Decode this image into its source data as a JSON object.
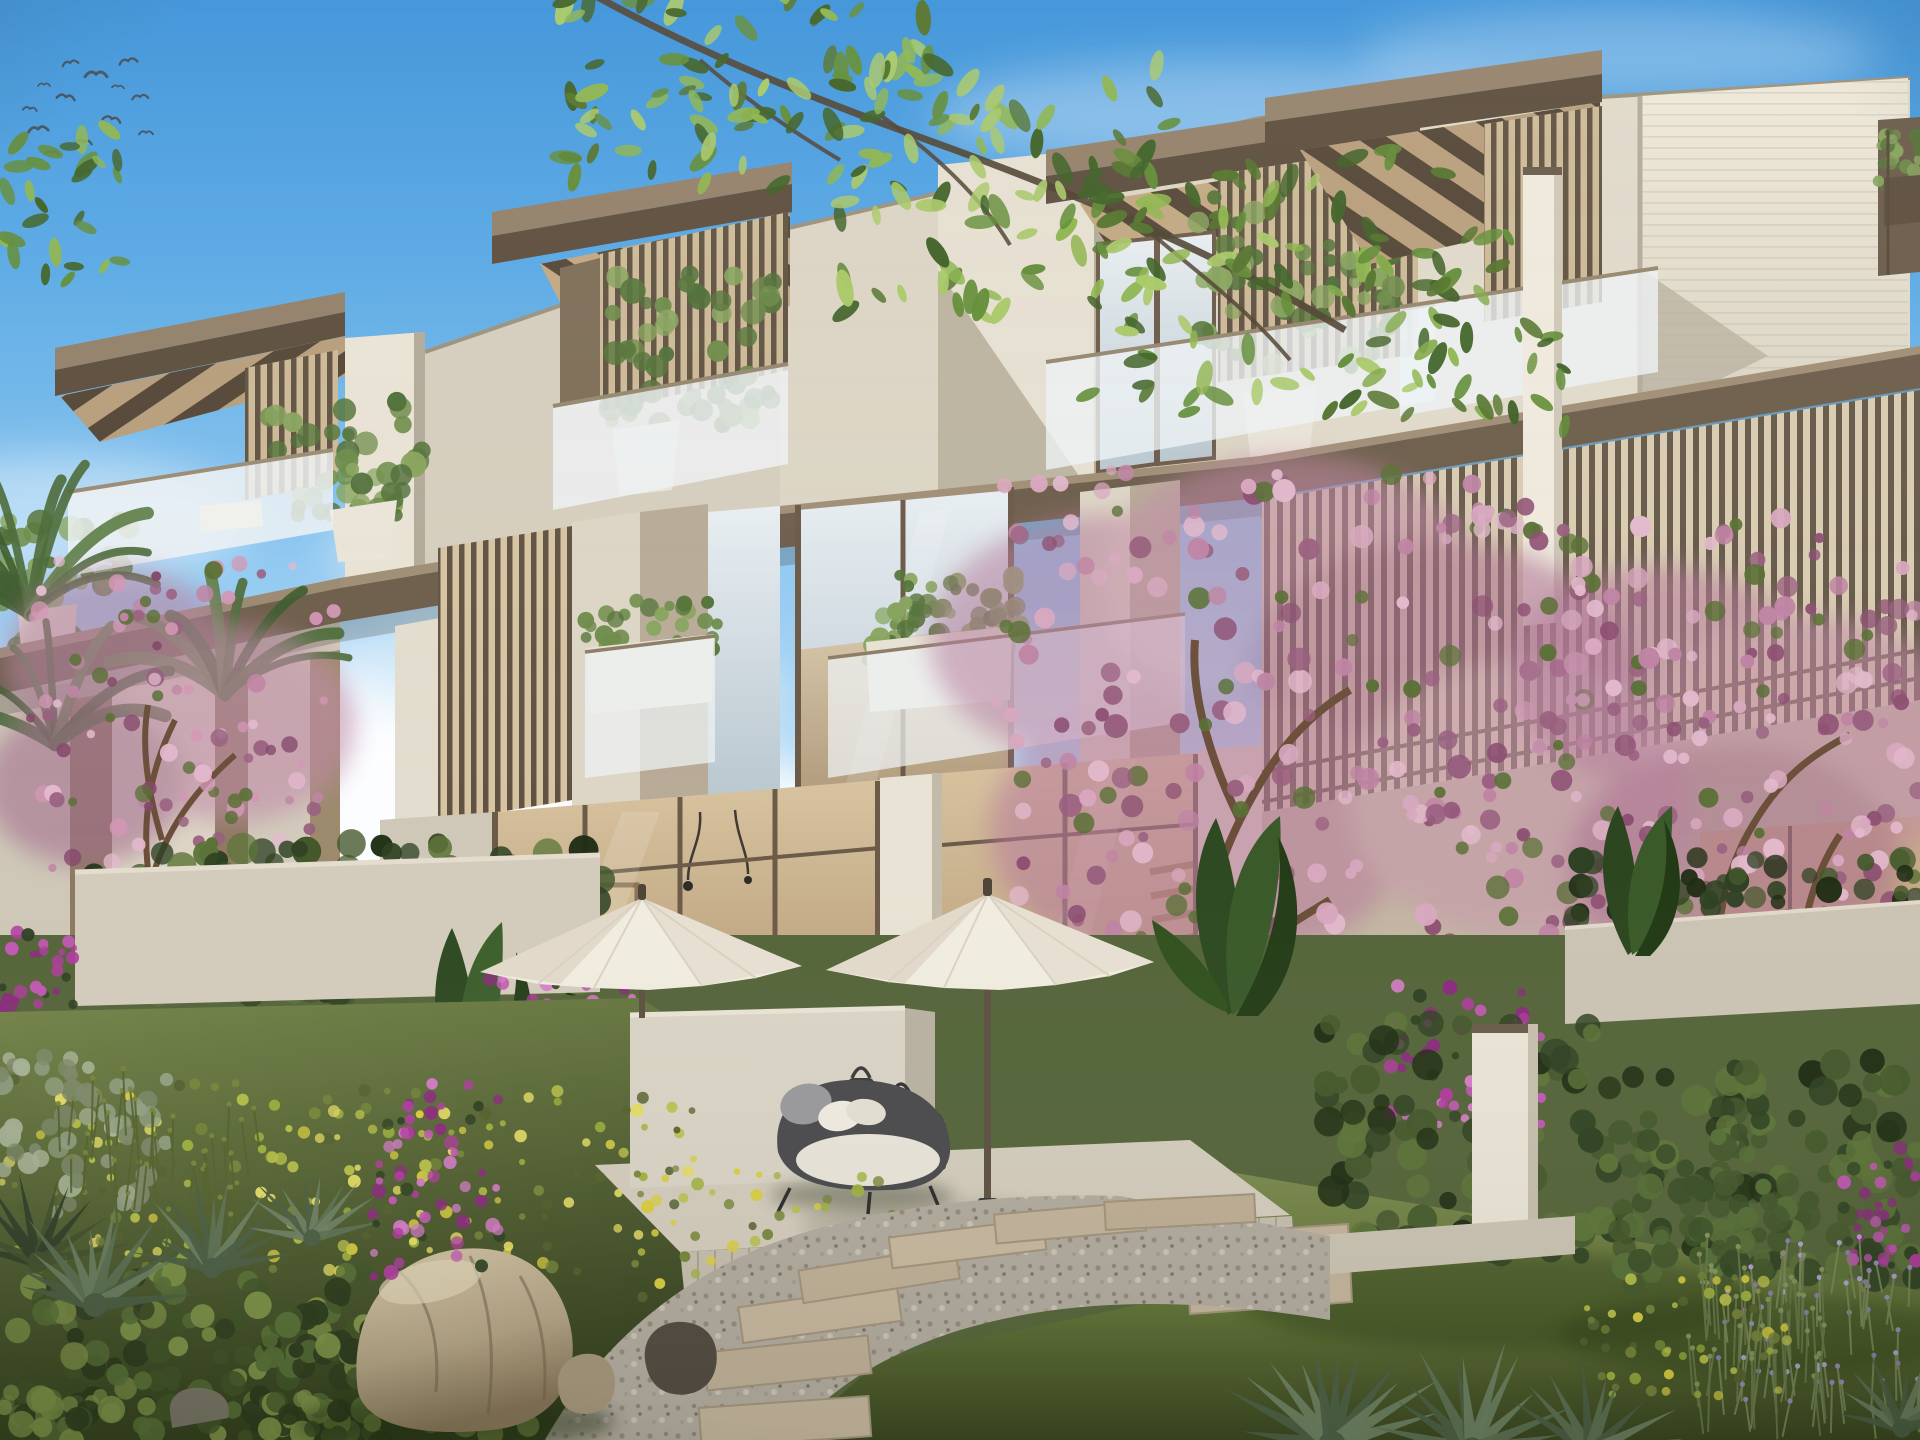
{
  "meta": {
    "content_type": "architectural-rendering",
    "subject": "modern three-storey townhouse terrace with landscaped garden, patio and flowering trees",
    "time_of_day": "day",
    "no_visible_text": true
  },
  "palette": {
    "sky_top": "#3e96dd",
    "sky_high": "#5fb0e9",
    "sky_mid": "#8fc9f1",
    "sky_low": "#c7e4f8",
    "cloud_white": "#f8fbfd",
    "bird": "#3f444b",
    "branch_wood": "#4f4232",
    "leaf_bright": "#8db54e",
    "leaf_mid": "#618c36",
    "leaf_dark": "#3e6126",
    "facade_light": "#e9e3d5",
    "facade_mid": "#d5cebe",
    "facade_shadow": "#b9b1a0",
    "soffit_warm": "#c2a883",
    "wood_fascia": "#5d4e3e",
    "wood_slab": "#93816a",
    "slat_dark": "#574a3b",
    "slat_backing": "#d2c0a0",
    "frame_bronze": "#6c5b49",
    "glass_sky": "#dfe9ee",
    "glass_warm": "#c9ae88",
    "balustrade_frost": "#eef2f5",
    "rail_bronze": "#8d7d67",
    "interior_wall": "#d9c4a2",
    "sofa_white": "#e9e3d7",
    "cushion_blue": "#67809a",
    "stair_wood": "#a5885f",
    "planter_white": "#eae5d8",
    "olive_green": "#6d8c4a",
    "blossom_light": "#e2b9cc",
    "blossom_mid": "#c084a4",
    "blossom_dark": "#99607f",
    "trunk_brown": "#6b4f3a",
    "palm_green": "#4c6b3a",
    "hedge_dark": "#2f4223",
    "hedge_mid": "#44582c",
    "hedge_light": "#5d7539",
    "flower_magenta": "#b13c9f",
    "flower_yellow": "#d9ce41",
    "drift_green": "#9fb33e",
    "agave_green": "#5d7254",
    "agave_light": "#8fa383",
    "silver_shrub": "#93a084",
    "lawn_light": "#7d8d4f",
    "lawn_mid": "#5e7036",
    "lawn_dark": "#3a4722",
    "gravel": "#b2ab9f",
    "path_stone": "#c3b49c",
    "kerb_stone": "#cbc4b4",
    "boulder_light": "#cdbd9f",
    "boulder_dark": "#8a7a5e",
    "rock_dark": "#4a443a",
    "deck_tile": "#d2cbbc",
    "privacy_wall": "#dad4c6",
    "furniture_shell": "#4a4a4d",
    "cushion_white": "#eae6da",
    "lantern_dark": "#3b3b3d",
    "umbrella_light": "#f1ece0",
    "umbrella_shade": "#d5cbb8",
    "umbrella_pole": "#5d5144",
    "lavender": "#9b8fc0"
  },
  "scene": {
    "sky": {
      "elements": [
        "gradient-sky",
        "cumulus-cloud-bank-left",
        "high-wisps",
        "flock-of-birds"
      ]
    },
    "building": {
      "storeys": 3,
      "units_visible": 4,
      "features": [
        "slatted-timber-canopies",
        "vertical-bronze-louvre-screens",
        "frosted-glass-balustrades",
        "travertine-piers",
        "floor-to-ceiling-glazing",
        "olive-trees-in-white-pots",
        "sunlit-blank-wall-with-diagonal-shadow"
      ]
    },
    "garden": {
      "features": [
        "pink-flowering-trees",
        "palm-fronds",
        "clipped-hedges",
        "purple-flower-beds",
        "yellow-green-drift",
        "agave-rosettes",
        "banana-plants",
        "boulder",
        "gravel-path-with-stepping-stones",
        "lawn",
        "lavender-bed"
      ]
    },
    "patio": {
      "items": [
        "privacy-wall",
        "daybed-with-white-cushion",
        "three-lanterns",
        "white-parasol-left",
        "white-parasol-right",
        "partial-parasol-far-right",
        "tiled-deck"
      ]
    }
  },
  "birds": [
    [
      38,
      128,
      10,
      -6
    ],
    [
      66,
      96,
      9,
      8
    ],
    [
      96,
      73,
      11,
      0
    ],
    [
      128,
      60,
      9,
      -10
    ],
    [
      84,
      141,
      8,
      5
    ],
    [
      52,
      152,
      7,
      0
    ],
    [
      112,
      118,
      9,
      12
    ],
    [
      140,
      96,
      8,
      -5
    ],
    [
      30,
      108,
      7,
      6
    ],
    [
      146,
      132,
      7,
      0
    ],
    [
      70,
      62,
      8,
      -12
    ],
    [
      118,
      86,
      6,
      4
    ],
    [
      44,
      84,
      6,
      0
    ]
  ],
  "scatters": [
    {
      "id": "leaves-1",
      "type": "leaves",
      "bounds": [
        540,
        -10,
        390,
        200
      ],
      "n": 75,
      "rmin": 9,
      "rmax": 19,
      "colors": [
        "#8db54e",
        "#618c36",
        "#3e6126",
        "#a8c868",
        "#54732e"
      ],
      "seed": 11
    },
    {
      "id": "leaves-2",
      "type": "leaves",
      "bounds": [
        830,
        60,
        340,
        265
      ],
      "n": 80,
      "rmin": 9,
      "rmax": 19,
      "colors": [
        "#8db54e",
        "#618c36",
        "#3e6126",
        "#a8c868",
        "#54732e"
      ],
      "seed": 12
    },
    {
      "id": "leaves-3",
      "type": "leaves",
      "bounds": [
        1085,
        150,
        370,
        270
      ],
      "n": 72,
      "rmin": 9,
      "rmax": 18,
      "colors": [
        "#8db54e",
        "#618c36",
        "#3e6126",
        "#a8c868",
        "#54732e"
      ],
      "seed": 13
    },
    {
      "id": "leaves-4",
      "type": "leaves",
      "bounds": [
        1330,
        235,
        235,
        195
      ],
      "n": 42,
      "rmin": 8,
      "rmax": 16,
      "colors": [
        "#7fa947",
        "#618c36",
        "#3e6126",
        "#54732e"
      ],
      "seed": 14
    },
    {
      "id": "leaves-corner",
      "type": "leaves",
      "bounds": [
        0,
        128,
        125,
        155
      ],
      "n": 28,
      "rmin": 8,
      "rmax": 15,
      "colors": [
        "#8db54e",
        "#618c36",
        "#3e6126"
      ],
      "seed": 15
    },
    {
      "id": "blossom-a",
      "type": "circles",
      "bounds": [
        15,
        555,
        330,
        315
      ],
      "n": 95,
      "rmin": 4,
      "rmax": 9.5,
      "colors": [
        "#e2b9cc",
        "#c084a4",
        "#99607f",
        "#d397b4",
        "#85486a"
      ],
      "green": "#5a7036",
      "seed": 21
    },
    {
      "id": "blossom-b",
      "type": "circles",
      "bounds": [
        995,
        468,
        590,
        545
      ],
      "n": 235,
      "rmin": 5,
      "rmax": 12,
      "colors": [
        "#e2b9cc",
        "#c084a4",
        "#99607f",
        "#d8a8bf",
        "#8d4f72"
      ],
      "green": "#5a7036",
      "seed": 22
    },
    {
      "id": "blossom-c",
      "type": "circles",
      "bounds": [
        1545,
        515,
        375,
        450
      ],
      "n": 165,
      "rmin": 5,
      "rmax": 11,
      "colors": [
        "#e2b9cc",
        "#c084a4",
        "#99607f",
        "#d8a8bf",
        "#8d4f72"
      ],
      "green": "#5a7036",
      "seed": 23
    },
    {
      "id": "purple-1",
      "type": "circles",
      "bounds": [
        483,
        973,
        185,
        145
      ],
      "n": 70,
      "rmin": 3.5,
      "rmax": 7.5,
      "colors": [
        "#b13c9f",
        "#c158b4",
        "#8b2c7e",
        "#d47cc7"
      ],
      "green": "#2f4223",
      "seed": 31
    },
    {
      "id": "purple-2",
      "type": "circles",
      "bounds": [
        372,
        1082,
        130,
        195
      ],
      "n": 60,
      "rmin": 3.5,
      "rmax": 7.5,
      "colors": [
        "#b13c9f",
        "#c158b4",
        "#8b2c7e",
        "#d47cc7"
      ],
      "green": "#2f4223",
      "seed": 32
    },
    {
      "id": "purple-3",
      "type": "circles",
      "bounds": [
        1390,
        983,
        158,
        148
      ],
      "n": 65,
      "rmin": 3.5,
      "rmax": 7.5,
      "colors": [
        "#b13c9f",
        "#c158b4",
        "#8b2c7e",
        "#d47cc7"
      ],
      "green": "#2f4223",
      "seed": 33
    },
    {
      "id": "purple-4",
      "type": "circles",
      "bounds": [
        0,
        922,
        75,
        88
      ],
      "n": 26,
      "rmin": 3.5,
      "rmax": 7,
      "colors": [
        "#b13c9f",
        "#c158b4",
        "#8b2c7e"
      ],
      "green": "#2f4223",
      "seed": 34
    },
    {
      "id": "purple-5",
      "type": "circles",
      "bounds": [
        1843,
        1148,
        77,
        118
      ],
      "n": 36,
      "rmin": 3.5,
      "rmax": 7,
      "colors": [
        "#b13c9f",
        "#c158b4",
        "#8b2c7e"
      ],
      "green": "#2f4223",
      "seed": 35
    },
    {
      "id": "drift-1",
      "type": "circles",
      "bounds": [
        0,
        1078,
        705,
        195
      ],
      "n": 175,
      "rmin": 3,
      "rmax": 6.5,
      "colors": [
        "#9fb33e",
        "#b8c24a",
        "#d9ce41",
        "#77863a",
        "#e4dc66"
      ],
      "green": "#55622e",
      "seed": 41
    },
    {
      "id": "drift-2",
      "type": "circles",
      "bounds": [
        640,
        1168,
        265,
        175
      ],
      "n": 70,
      "rmin": 3,
      "rmax": 6.5,
      "colors": [
        "#9fb33e",
        "#b8c24a",
        "#d9ce41",
        "#77863a"
      ],
      "green": "#55622e",
      "seed": 42
    },
    {
      "id": "drift-3",
      "type": "circles",
      "bounds": [
        1582,
        1272,
        205,
        125
      ],
      "n": 55,
      "rmin": 3,
      "rmax": 6,
      "colors": [
        "#9fb33e",
        "#b8c24a",
        "#d9ce41",
        "#77863a"
      ],
      "green": "#55622e",
      "seed": 43
    },
    {
      "id": "hedge-left",
      "type": "circles",
      "bounds": [
        85,
        842,
        525,
        155
      ],
      "n": 130,
      "rmin": 8,
      "rmax": 16,
      "colors": [
        "#2f4223",
        "#44582c",
        "#1f2d14",
        "#5d7539"
      ],
      "seed": 51
    },
    {
      "id": "hedge-r1",
      "type": "circles",
      "bounds": [
        1322,
        1022,
        345,
        235
      ],
      "n": 105,
      "rmin": 8,
      "rmax": 16,
      "colors": [
        "#2f4223",
        "#44582c",
        "#1f2d14",
        "#5d7539"
      ],
      "seed": 52
    },
    {
      "id": "hedge-r2",
      "type": "circles",
      "bounds": [
        1690,
        1058,
        230,
        220
      ],
      "n": 85,
      "rmin": 8,
      "rmax": 16,
      "colors": [
        "#2f4223",
        "#44582c",
        "#1f2d14",
        "#5d7539"
      ],
      "seed": 53
    },
    {
      "id": "hedge-ball",
      "type": "circles",
      "bounds": [
        1615,
        1132,
        180,
        155
      ],
      "n": 58,
      "rmin": 7,
      "rmax": 14,
      "colors": [
        "#3a4f28",
        "#44582c",
        "#567038"
      ],
      "seed": 54
    },
    {
      "id": "hedge-back",
      "type": "circles",
      "bounds": [
        1568,
        852,
        352,
        100
      ],
      "n": 60,
      "rmin": 7,
      "rmax": 14,
      "colors": [
        "#2f4223",
        "#44582c",
        "#1f2d14"
      ],
      "seed": 55
    },
    {
      "id": "bush-l1",
      "type": "circles",
      "bounds": [
        0,
        1272,
        365,
        170
      ],
      "n": 130,
      "rmin": 7,
      "rmax": 14,
      "colors": [
        "#2c3a1c",
        "#405427",
        "#587137",
        "#7f9448"
      ],
      "seed": 61
    },
    {
      "id": "bush-l2",
      "type": "circles",
      "bounds": [
        262,
        1318,
        270,
        128
      ],
      "n": 85,
      "rmin": 7,
      "rmax": 14,
      "colors": [
        "#2c3a1c",
        "#405427",
        "#587137",
        "#7f9448"
      ],
      "seed": 62
    },
    {
      "id": "shrub-silver",
      "type": "circles",
      "bounds": [
        0,
        1055,
        175,
        160
      ],
      "n": 55,
      "rmin": 6,
      "rmax": 12,
      "colors": [
        "#93a084",
        "#7e8a6b",
        "#a9b497"
      ],
      "seed": 63
    },
    {
      "id": "planter-shrub-1",
      "type": "circles",
      "bounds": [
        585,
        600,
        135,
        70
      ],
      "n": 40,
      "rmin": 5,
      "rmax": 10,
      "colors": [
        "#6d8c4a",
        "#55743a",
        "#87a45e"
      ],
      "seed": 71
    },
    {
      "id": "planter-shrub-2",
      "type": "circles",
      "bounds": [
        865,
        598,
        150,
        70
      ],
      "n": 45,
      "rmin": 5,
      "rmax": 10,
      "colors": [
        "#6d8c4a",
        "#55743a",
        "#87a45e"
      ],
      "seed": 72
    },
    {
      "id": "planter-shrub-3",
      "type": "circles",
      "bounds": [
        1878,
        132,
        44,
        60
      ],
      "n": 25,
      "rmin": 4,
      "rmax": 8,
      "colors": [
        "#6d8c4a",
        "#55743a",
        "#87a45e"
      ],
      "seed": 73
    },
    {
      "id": "olive-a1",
      "type": "circles",
      "bounds": [
        0,
        512,
        130,
        135
      ],
      "n": 40,
      "rmin": 6,
      "rmax": 13,
      "colors": [
        "#6d8c4a",
        "#55743a",
        "#87a45e",
        "#4f6e38"
      ],
      "seed": 81
    },
    {
      "id": "olive-a2",
      "type": "circles",
      "bounds": [
        262,
        396,
        160,
        125
      ],
      "n": 45,
      "rmin": 6,
      "rmax": 13,
      "colors": [
        "#6d8c4a",
        "#55743a",
        "#87a45e",
        "#4f6e38"
      ],
      "seed": 82
    },
    {
      "id": "olive-b",
      "type": "circles",
      "bounds": [
        598,
        272,
        175,
        160
      ],
      "n": 50,
      "rmin": 6,
      "rmax": 13,
      "colors": [
        "#6d8c4a",
        "#55743a",
        "#87a45e",
        "#4f6e38"
      ],
      "seed": 83
    },
    {
      "id": "olive-c",
      "type": "circles",
      "bounds": [
        1195,
        192,
        210,
        175
      ],
      "n": 55,
      "rmin": 6,
      "rmax": 14,
      "colors": [
        "#6d8c4a",
        "#55743a",
        "#87a45e",
        "#4f6e38"
      ],
      "seed": 84
    },
    {
      "id": "olive-mid-c",
      "type": "circles",
      "bounds": [
        880,
        565,
        140,
        110
      ],
      "n": 35,
      "rmin": 5,
      "rmax": 11,
      "colors": [
        "#6d8c4a",
        "#55743a",
        "#87a45e"
      ],
      "seed": 85
    },
    {
      "id": "agave-1",
      "type": "rosette",
      "cx": 95,
      "cy": 1305,
      "r": 100,
      "n": 12,
      "colors": [
        "#5d7254",
        "#6d8162",
        "#4b5f45"
      ],
      "seed": 91
    },
    {
      "id": "agave-2",
      "type": "rosette",
      "cx": 212,
      "cy": 1268,
      "r": 85,
      "n": 11,
      "colors": [
        "#5d7254",
        "#6d8162",
        "#4b5f45"
      ],
      "seed": 92
    },
    {
      "id": "agave-3",
      "type": "rosette",
      "cx": 312,
      "cy": 1238,
      "r": 72,
      "n": 10,
      "colors": [
        "#5d7254",
        "#6d8162",
        "#4b5f45"
      ],
      "seed": 93
    },
    {
      "id": "agave-4",
      "type": "rosette",
      "cx": 1332,
      "cy": 1445,
      "r": 115,
      "n": 12,
      "colors": [
        "#5d7254",
        "#6d8162",
        "#4b5f45"
      ],
      "seed": 94
    },
    {
      "id": "agave-5",
      "type": "rosette",
      "cx": 1472,
      "cy": 1450,
      "r": 105,
      "n": 11,
      "colors": [
        "#5d7254",
        "#6d8162",
        "#4b5f45"
      ],
      "seed": 95
    },
    {
      "id": "agave-6",
      "type": "rosette",
      "cx": 1590,
      "cy": 1452,
      "r": 92,
      "n": 10,
      "colors": [
        "#5d7254",
        "#6d8162",
        "#4b5f45"
      ],
      "seed": 96
    },
    {
      "id": "agave-7",
      "type": "rosette",
      "cx": 1902,
      "cy": 1428,
      "r": 80,
      "n": 9,
      "colors": [
        "#5d7254",
        "#6d8162",
        "#4b5f45"
      ],
      "seed": 97
    },
    {
      "id": "agave-dark",
      "type": "rosette",
      "cx": 38,
      "cy": 1262,
      "r": 88,
      "n": 10,
      "colors": [
        "#33402a",
        "#44522f"
      ],
      "seed": 98
    },
    {
      "id": "palm-1",
      "type": "fronds",
      "cx": 30,
      "cy": 615,
      "r": 175,
      "n": 10,
      "seed": 101
    },
    {
      "id": "palm-2",
      "type": "fronds",
      "cx": 225,
      "cy": 695,
      "r": 125,
      "n": 8,
      "seed": 102
    },
    {
      "id": "palm-3",
      "type": "fronds",
      "cx": 55,
      "cy": 745,
      "r": 140,
      "n": 7,
      "seed": 103
    },
    {
      "id": "lavender",
      "type": "stems",
      "bounds": [
        1722,
        1288,
        198,
        152
      ],
      "n": 62,
      "len": [
        28,
        58
      ],
      "stem": "#7b8a5a",
      "tips": [
        "#9b8fc0",
        "#8f7fb8",
        "#b3a8d6"
      ],
      "seed": 111
    },
    {
      "id": "grass",
      "type": "stems",
      "bounds": [
        1692,
        1298,
        135,
        142
      ],
      "n": 42,
      "len": [
        40,
        78
      ],
      "stem": "#6a7a4a",
      "tips": [
        "#88985c"
      ],
      "seed": 112
    },
    {
      "id": "reed-left",
      "type": "stems",
      "bounds": [
        55,
        1135,
        210,
        120
      ],
      "n": 45,
      "len": [
        35,
        70
      ],
      "stem": "#55622e",
      "tips": [
        "#77863a"
      ],
      "seed": 113
    }
  ]
}
